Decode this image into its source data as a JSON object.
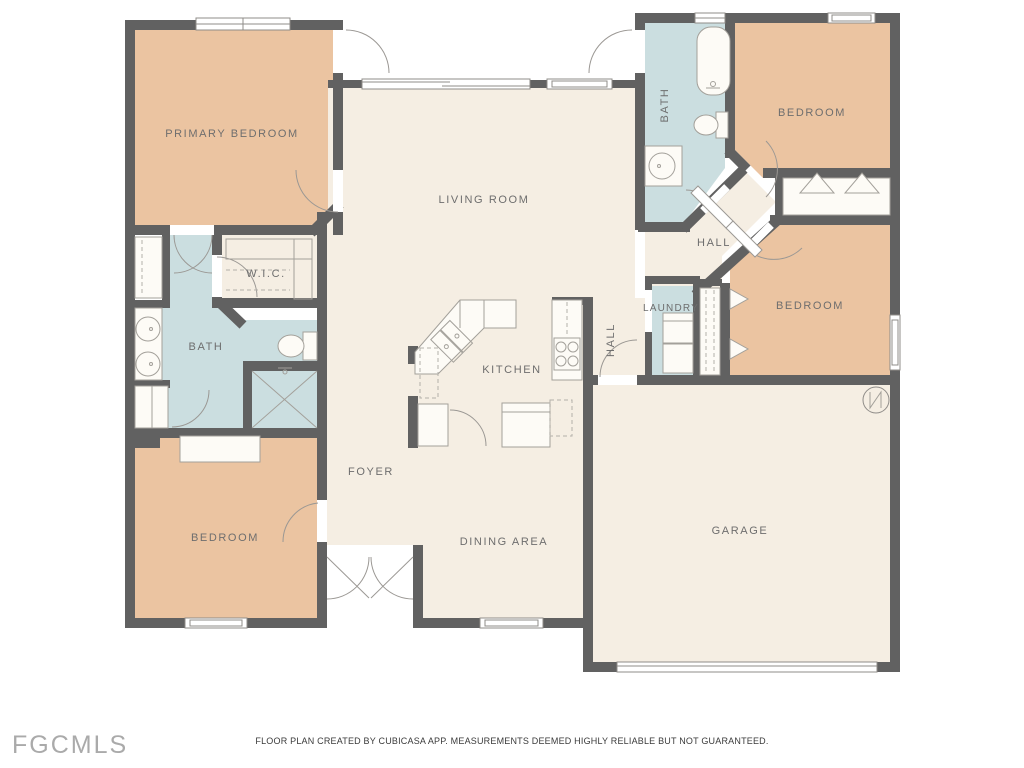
{
  "watermark": "FGCMLS",
  "footer": "FLOOR PLAN CREATED BY CUBICASA APP. MEASUREMENTS DEEMED HIGHLY RELIABLE BUT NOT GUARANTEED.",
  "labels": {
    "primary_bedroom": "PRIMARY BEDROOM",
    "living_room": "LIVING ROOM",
    "wic": "W.I.C.",
    "bath_primary": "BATH",
    "bath_guest": "BATH",
    "bedroom_top_right": "BEDROOM",
    "bedroom_right": "BEDROOM",
    "bedroom_bottom_left": "BEDROOM",
    "hall_upper": "HALL",
    "hall_lower": "HALL",
    "laundry": "LAUNDRY",
    "kitchen": "KITCHEN",
    "foyer": "FOYER",
    "dining_area": "DINING AREA",
    "garage": "GARAGE"
  },
  "colors": {
    "wall": "#616161",
    "bedroom_floor": "#ebc4a1",
    "common_floor": "#f5eee3",
    "bath_floor": "#cbdee0",
    "label_text": "#6e6e6e",
    "background": "#ffffff"
  }
}
